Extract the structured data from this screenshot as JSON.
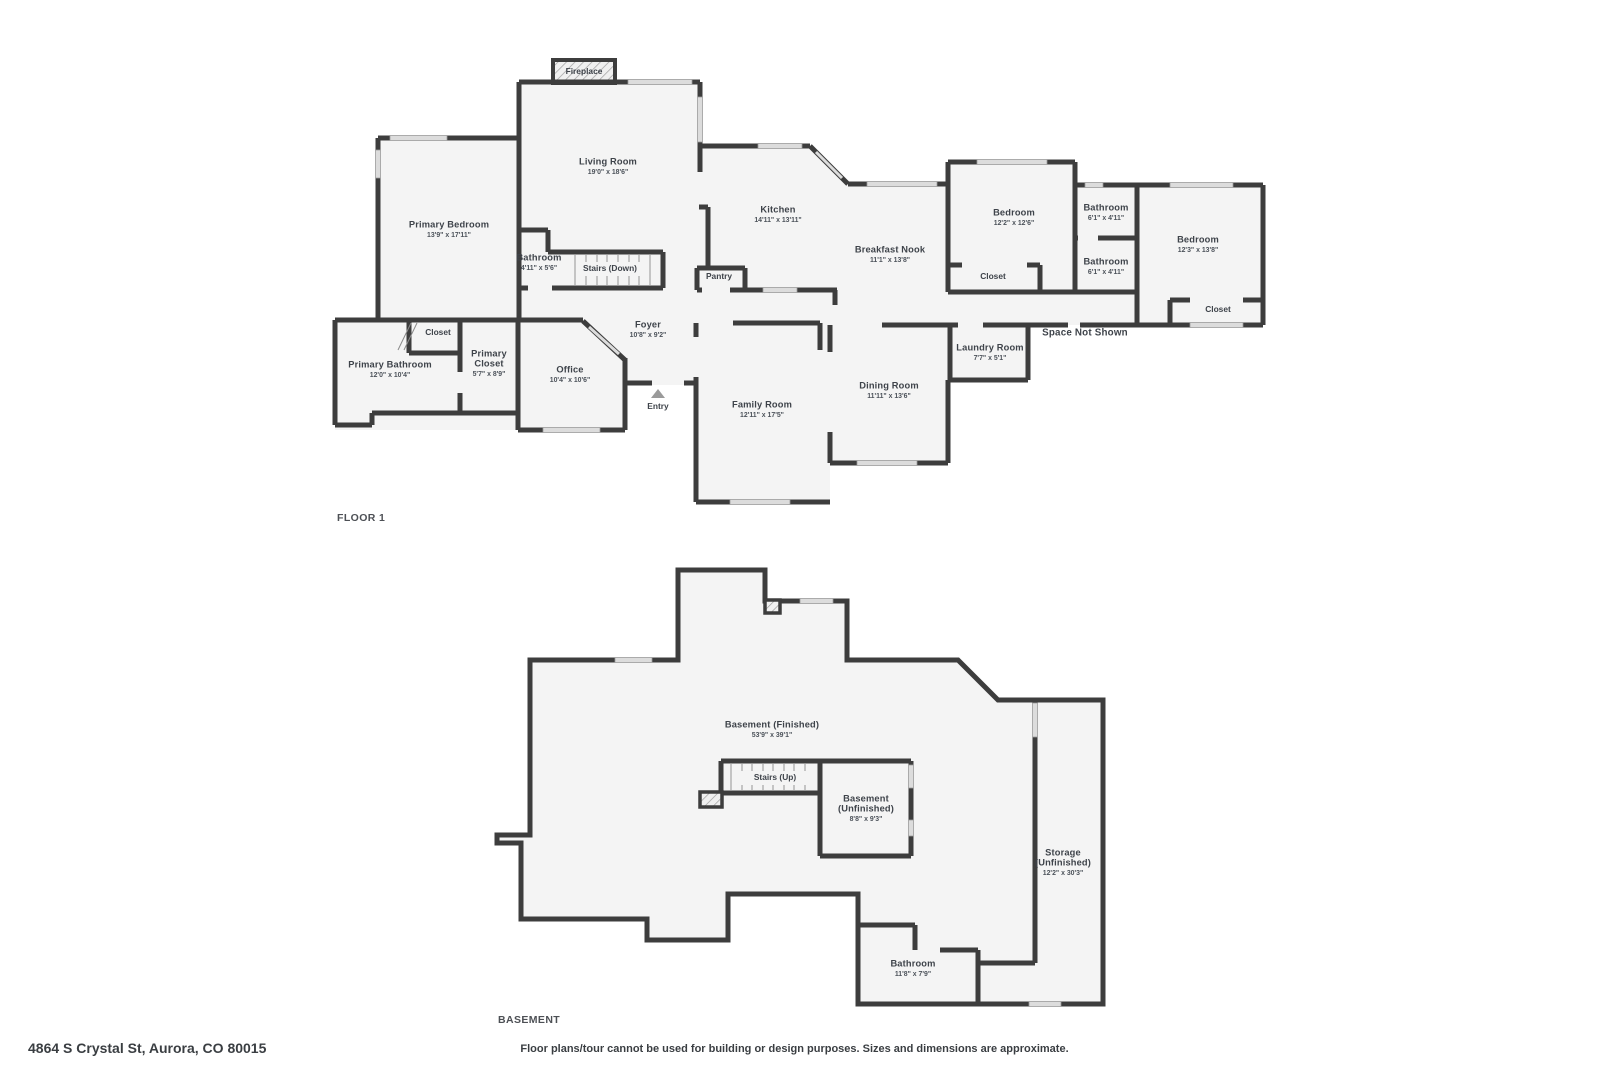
{
  "document": {
    "floor1_title": "FLOOR 1",
    "basement_title": "BASEMENT",
    "address": "4864 S Crystal St, Aurora, CO 80015",
    "disclaimer": "Floor plans/tour cannot be used for building or design purposes. Sizes and dimensions are approximate."
  },
  "colors": {
    "wall": "#3d3d3d",
    "floor": "#f4f4f4",
    "window": "#dcdcdc",
    "label_text": "#3e434a",
    "background": "#ffffff"
  },
  "floor1_labels": [
    {
      "x": 584,
      "lines": [
        {
          "t": "Fireplace",
          "y": 72,
          "cls": "small"
        }
      ]
    },
    {
      "x": 608,
      "lines": [
        {
          "t": "Living Room",
          "y": 162,
          "cls": "name"
        },
        {
          "t": "19'0\" x 18'6\"",
          "y": 172,
          "cls": "dims"
        }
      ]
    },
    {
      "x": 449,
      "lines": [
        {
          "t": "Primary Bedroom",
          "y": 225,
          "cls": "name"
        },
        {
          "t": "13'9\" x 17'11\"",
          "y": 235,
          "cls": "dims"
        }
      ]
    },
    {
      "x": 778,
      "lines": [
        {
          "t": "Kitchen",
          "y": 210,
          "cls": "name"
        },
        {
          "t": "14'11\" x 13'11\"",
          "y": 220,
          "cls": "dims"
        }
      ]
    },
    {
      "x": 890,
      "lines": [
        {
          "t": "Breakfast Nook",
          "y": 250,
          "cls": "name"
        },
        {
          "t": "11'1\" x 13'8\"",
          "y": 260,
          "cls": "dims"
        }
      ]
    },
    {
      "x": 1014,
      "lines": [
        {
          "t": "Bedroom",
          "y": 213,
          "cls": "name"
        },
        {
          "t": "12'2\" x 12'6\"",
          "y": 223,
          "cls": "dims"
        }
      ]
    },
    {
      "x": 1106,
      "lines": [
        {
          "t": "Bathroom",
          "y": 208,
          "cls": "name"
        },
        {
          "t": "6'1\" x 4'11\"",
          "y": 218,
          "cls": "dims"
        }
      ]
    },
    {
      "x": 1106,
      "lines": [
        {
          "t": "Bathroom",
          "y": 262,
          "cls": "name"
        },
        {
          "t": "6'1\" x 4'11\"",
          "y": 272,
          "cls": "dims"
        }
      ]
    },
    {
      "x": 1198,
      "lines": [
        {
          "t": "Bedroom",
          "y": 240,
          "cls": "name"
        },
        {
          "t": "12'3\" x 13'8\"",
          "y": 250,
          "cls": "dims"
        }
      ]
    },
    {
      "x": 1218,
      "lines": [
        {
          "t": "Closet",
          "y": 310,
          "cls": "small"
        }
      ]
    },
    {
      "x": 993,
      "lines": [
        {
          "t": "Closet",
          "y": 277,
          "cls": "small"
        }
      ]
    },
    {
      "x": 1085,
      "lines": [
        {
          "t": "Space Not Shown",
          "y": 333,
          "cls": "big"
        }
      ]
    },
    {
      "x": 990,
      "lines": [
        {
          "t": "Laundry Room",
          "y": 348,
          "cls": "name"
        },
        {
          "t": "7'7\" x 5'1\"",
          "y": 358,
          "cls": "dims"
        }
      ]
    },
    {
      "x": 889,
      "lines": [
        {
          "t": "Dining Room",
          "y": 386,
          "cls": "name"
        },
        {
          "t": "11'11\" x 13'6\"",
          "y": 396,
          "cls": "dims"
        }
      ]
    },
    {
      "x": 762,
      "lines": [
        {
          "t": "Family Room",
          "y": 405,
          "cls": "name"
        },
        {
          "t": "12'11\" x 17'5\"",
          "y": 415,
          "cls": "dims"
        }
      ]
    },
    {
      "x": 648,
      "lines": [
        {
          "t": "Foyer",
          "y": 325,
          "cls": "name"
        },
        {
          "t": "10'8\" x 9'2\"",
          "y": 335,
          "cls": "dims"
        }
      ]
    },
    {
      "x": 570,
      "lines": [
        {
          "t": "Office",
          "y": 370,
          "cls": "name"
        },
        {
          "t": "10'4\" x 10'6\"",
          "y": 380,
          "cls": "dims"
        }
      ]
    },
    {
      "x": 489,
      "lines": [
        {
          "t": "Primary",
          "y": 354,
          "cls": "name"
        },
        {
          "t": "Closet",
          "y": 364,
          "cls": "name"
        },
        {
          "t": "5'7\" x 8'9\"",
          "y": 374,
          "cls": "dims"
        }
      ]
    },
    {
      "x": 438,
      "lines": [
        {
          "t": "Closet",
          "y": 333,
          "cls": "small"
        }
      ]
    },
    {
      "x": 390,
      "lines": [
        {
          "t": "Primary Bathroom",
          "y": 365,
          "cls": "name"
        },
        {
          "t": "12'0\" x 10'4\"",
          "y": 375,
          "cls": "dims"
        }
      ]
    },
    {
      "x": 539,
      "lines": [
        {
          "t": "Bathroom",
          "y": 258,
          "cls": "name"
        },
        {
          "t": "4'11\" x 5'6\"",
          "y": 268,
          "cls": "dims"
        }
      ]
    },
    {
      "x": 610,
      "lines": [
        {
          "t": "Stairs (Down)",
          "y": 269,
          "cls": "small"
        }
      ]
    },
    {
      "x": 719,
      "lines": [
        {
          "t": "Pantry",
          "y": 277,
          "cls": "small"
        }
      ]
    },
    {
      "x": 658,
      "lines": [
        {
          "t": "Entry",
          "y": 407,
          "cls": "small"
        }
      ]
    }
  ],
  "basement_labels": [
    {
      "x": 772,
      "lines": [
        {
          "t": "Basement (Finished)",
          "y": 725,
          "cls": "name"
        },
        {
          "t": "53'9\" x 39'1\"",
          "y": 735,
          "cls": "dims"
        }
      ]
    },
    {
      "x": 775,
      "lines": [
        {
          "t": "Stairs (Up)",
          "y": 778,
          "cls": "small"
        }
      ]
    },
    {
      "x": 866,
      "lines": [
        {
          "t": "Basement",
          "y": 799,
          "cls": "name"
        },
        {
          "t": "(Unfinished)",
          "y": 809,
          "cls": "name"
        },
        {
          "t": "8'8\" x 9'3\"",
          "y": 819,
          "cls": "dims"
        }
      ]
    },
    {
      "x": 1063,
      "lines": [
        {
          "t": "Storage",
          "y": 853,
          "cls": "name"
        },
        {
          "t": "(Unfinished)",
          "y": 863,
          "cls": "name"
        },
        {
          "t": "12'2\" x 30'3\"",
          "y": 873,
          "cls": "dims"
        }
      ]
    },
    {
      "x": 913,
      "lines": [
        {
          "t": "Bathroom",
          "y": 964,
          "cls": "name"
        },
        {
          "t": "11'8\" x 7'9\"",
          "y": 974,
          "cls": "dims"
        }
      ]
    }
  ]
}
